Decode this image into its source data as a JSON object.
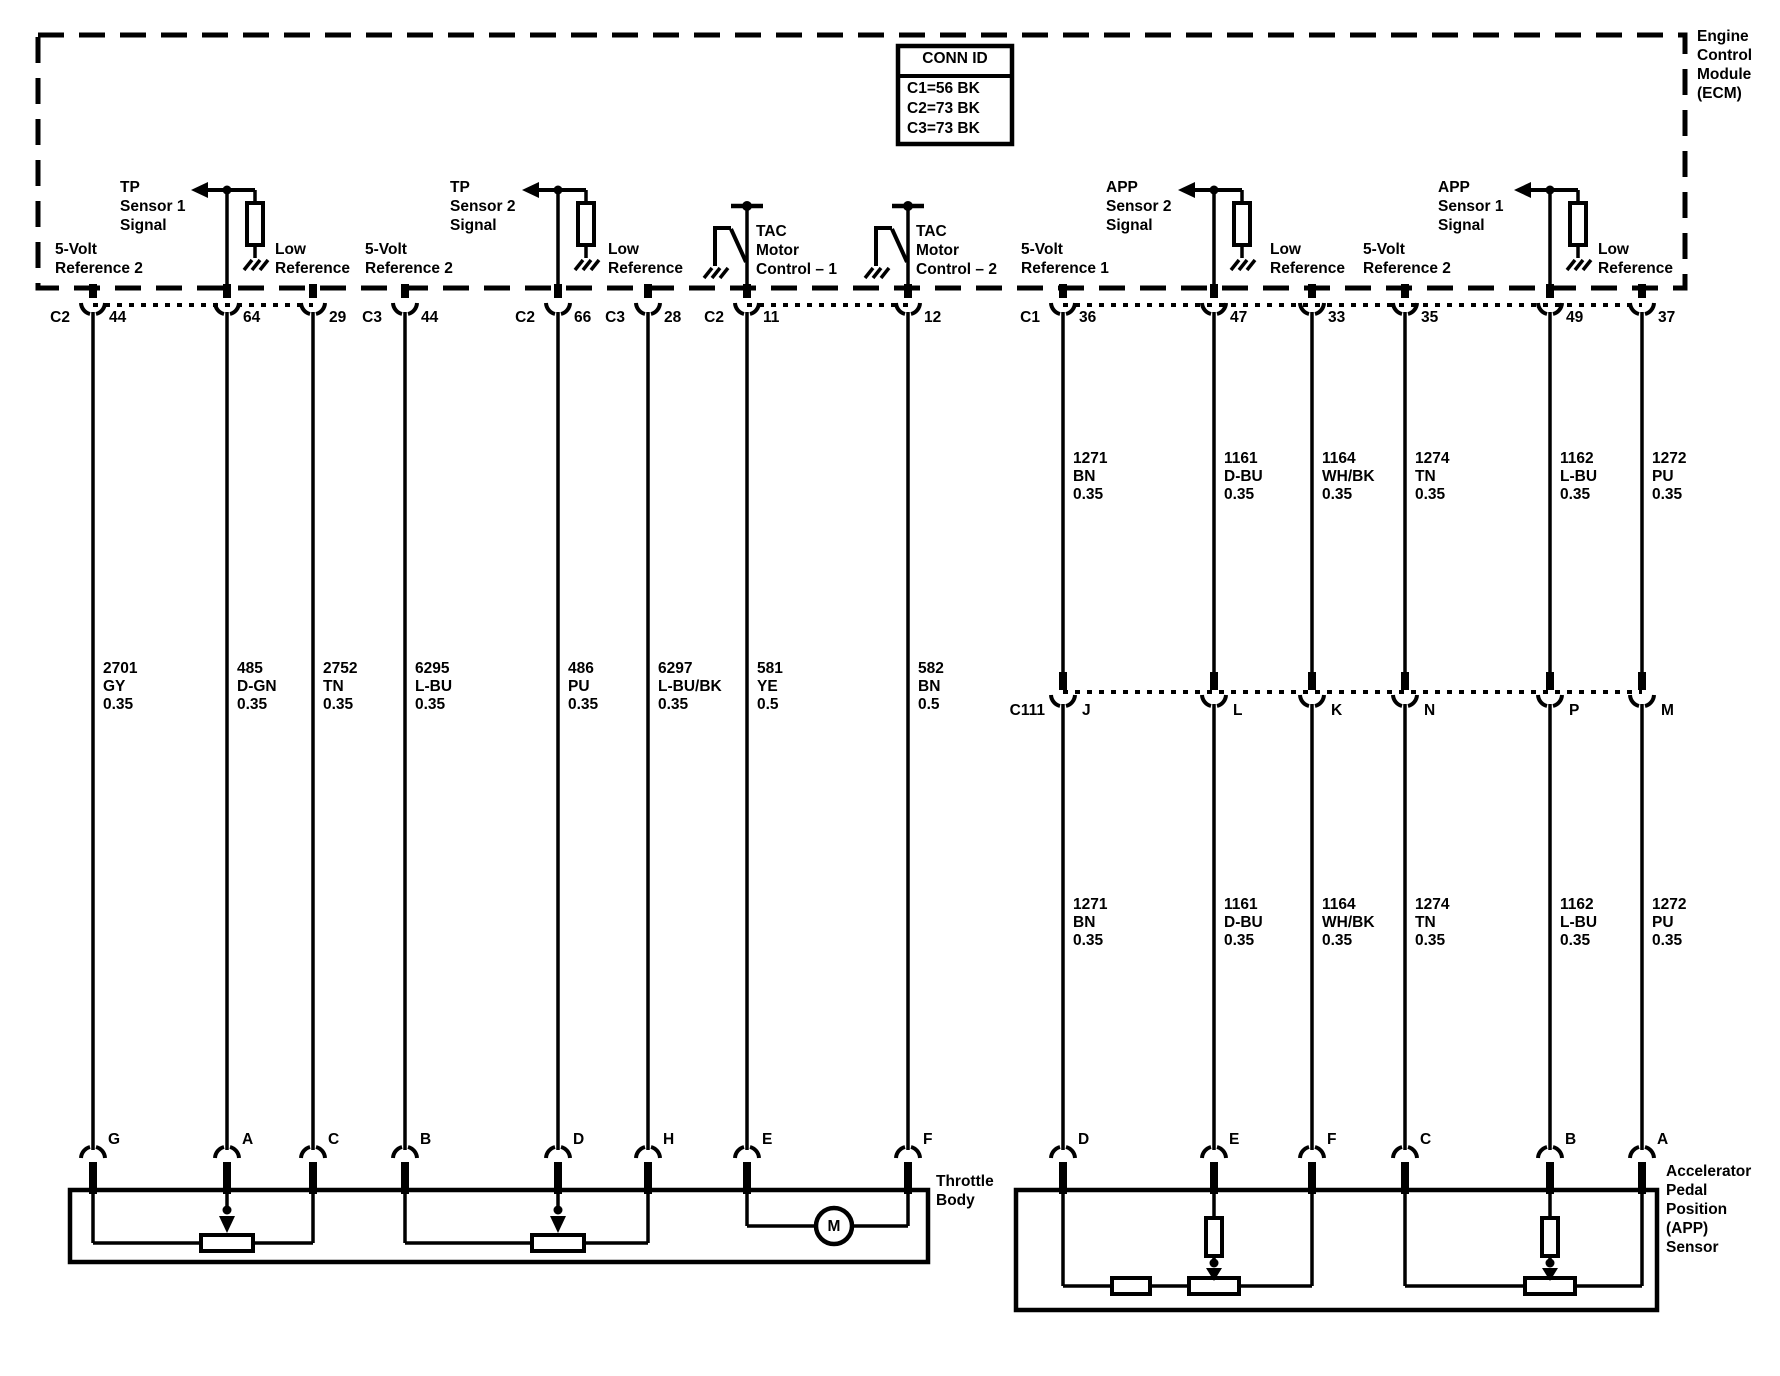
{
  "ecm": {
    "label_lines": [
      "Engine",
      "Control",
      "Module",
      "(ECM)"
    ]
  },
  "conn_id_table": {
    "header": "CONN ID",
    "rows": [
      "C1=56 BK",
      "C2=73 BK",
      "C3=73 BK"
    ]
  },
  "signal_labels": [
    {
      "lines": [
        "5-Volt",
        "Reference 2"
      ]
    },
    {
      "lines": [
        "TP",
        "Sensor 1",
        "Signal"
      ]
    },
    {
      "lines": [
        "Low",
        "Reference"
      ]
    },
    {
      "lines": [
        "5-Volt",
        "Reference 2"
      ]
    },
    {
      "lines": [
        "TP",
        "Sensor 2",
        "Signal"
      ]
    },
    {
      "lines": [
        "Low",
        "Reference"
      ]
    },
    {
      "lines": [
        "TAC",
        "Motor",
        "Control – 1"
      ]
    },
    {
      "lines": [
        "TAC",
        "Motor",
        "Control – 2"
      ]
    },
    {
      "lines": [
        "5-Volt",
        "Reference 1"
      ]
    },
    {
      "lines": [
        "APP",
        "Sensor 2",
        "Signal"
      ]
    },
    {
      "lines": [
        "Low",
        "Reference"
      ]
    },
    {
      "lines": [
        "5-Volt",
        "Reference 2"
      ]
    },
    {
      "lines": [
        "APP",
        "Sensor 1",
        "Signal"
      ]
    },
    {
      "lines": [
        "Low",
        "Reference"
      ]
    }
  ],
  "columns": [
    {
      "connector": "C2",
      "pin": "44",
      "component_pin": "G",
      "wire": {
        "circuit": "2701",
        "color": "GY",
        "gauge": "0.35"
      }
    },
    {
      "pin": "64",
      "component_pin": "A",
      "wire": {
        "circuit": "485",
        "color": "D-GN",
        "gauge": "0.35"
      }
    },
    {
      "pin": "29",
      "component_pin": "C",
      "wire": {
        "circuit": "2752",
        "color": "TN",
        "gauge": "0.35"
      }
    },
    {
      "connector": "C3",
      "pin": "44",
      "component_pin": "B",
      "wire": {
        "circuit": "6295",
        "color": "L-BU",
        "gauge": "0.35"
      }
    },
    {
      "connector": "C2",
      "pin": "66",
      "component_pin": "D",
      "wire": {
        "circuit": "486",
        "color": "PU",
        "gauge": "0.35"
      }
    },
    {
      "connector": "C3",
      "pin": "28",
      "component_pin": "H",
      "wire": {
        "circuit": "6297",
        "color": "L-BU/BK",
        "gauge": "0.35"
      }
    },
    {
      "connector": "C2",
      "pin": "11",
      "component_pin": "E",
      "wire": {
        "circuit": "581",
        "color": "YE",
        "gauge": "0.5"
      }
    },
    {
      "pin": "12",
      "component_pin": "F",
      "wire": {
        "circuit": "582",
        "color": "BN",
        "gauge": "0.5"
      }
    },
    {
      "connector": "C1",
      "pin": "36",
      "c111_pin": "J",
      "component_pin": "D",
      "wire": {
        "circuit": "1271",
        "color": "BN",
        "gauge": "0.35"
      }
    },
    {
      "pin": "47",
      "c111_pin": "L",
      "component_pin": "E",
      "wire": {
        "circuit": "1161",
        "color": "D-BU",
        "gauge": "0.35"
      }
    },
    {
      "pin": "33",
      "c111_pin": "K",
      "component_pin": "F",
      "wire": {
        "circuit": "1164",
        "color": "WH/BK",
        "gauge": "0.35"
      }
    },
    {
      "pin": "35",
      "c111_pin": "N",
      "component_pin": "C",
      "wire": {
        "circuit": "1274",
        "color": "TN",
        "gauge": "0.35"
      }
    },
    {
      "pin": "49",
      "c111_pin": "P",
      "component_pin": "B",
      "wire": {
        "circuit": "1162",
        "color": "L-BU",
        "gauge": "0.35"
      }
    },
    {
      "pin": "37",
      "c111_pin": "M",
      "component_pin": "A",
      "wire": {
        "circuit": "1272",
        "color": "PU",
        "gauge": "0.35"
      }
    }
  ],
  "inline_connector": {
    "label": "C111"
  },
  "components": {
    "throttle_body": {
      "label_lines": [
        "Throttle",
        "Body"
      ],
      "motor_label": "M"
    },
    "app_sensor": {
      "label_lines": [
        "Accelerator",
        "Pedal",
        "Position",
        "(APP)",
        "Sensor"
      ]
    }
  }
}
